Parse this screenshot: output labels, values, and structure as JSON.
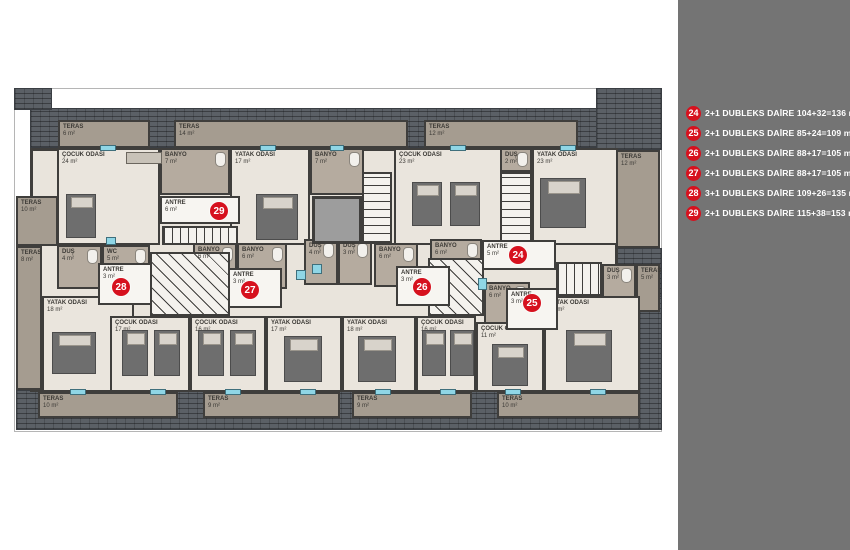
{
  "legend": {
    "items": [
      {
        "no": "24",
        "text": "2+1 DUBLEKS DAİRE 104+32=136 m²"
      },
      {
        "no": "25",
        "text": "2+1 DUBLEKS DAİRE 85+24=109 m²"
      },
      {
        "no": "26",
        "text": "2+1 DUBLEKS DAİRE 88+17=105 m²"
      },
      {
        "no": "27",
        "text": "2+1 DUBLEKS DAİRE 88+17=105 m²"
      },
      {
        "no": "28",
        "text": "3+1 DUBLEKS DAİRE 109+26=135 m²"
      },
      {
        "no": "29",
        "text": "2+1 DUBLEKS DAİRE 115+38=153 m²"
      }
    ],
    "panel_color": "#747474",
    "badge_color": "#d6111e"
  },
  "plan": {
    "hatch": [
      {
        "x": 30,
        "y": 108,
        "w": 586,
        "h": 40
      },
      {
        "x": 14,
        "y": 88,
        "w": 38,
        "h": 22
      },
      {
        "x": 596,
        "y": 88,
        "w": 66,
        "h": 62
      },
      {
        "x": 614,
        "y": 248,
        "w": 48,
        "h": 62
      },
      {
        "x": 612,
        "y": 296,
        "w": 50,
        "h": 134
      },
      {
        "x": 16,
        "y": 390,
        "w": 624,
        "h": 40
      }
    ],
    "rooms": [
      {
        "kind": "terrace",
        "name": "TERAS",
        "area": "6 m²",
        "x": 58,
        "y": 120,
        "w": 92,
        "h": 28
      },
      {
        "kind": "terrace",
        "name": "TERAS",
        "area": "14 m²",
        "x": 174,
        "y": 120,
        "w": 234,
        "h": 28
      },
      {
        "kind": "terrace",
        "name": "TERAS",
        "area": "12 m²",
        "x": 424,
        "y": 120,
        "w": 154,
        "h": 28
      },
      {
        "kind": "terrace",
        "name": "TERAS",
        "area": "12 m²",
        "x": 616,
        "y": 150,
        "w": 44,
        "h": 98
      },
      {
        "kind": "terrace",
        "name": "TERAS",
        "area": "10 m²",
        "x": 16,
        "y": 196,
        "w": 42,
        "h": 50
      },
      {
        "kind": "terrace",
        "name": "TERAS",
        "area": "8 m²",
        "x": 16,
        "y": 246,
        "w": 26,
        "h": 144
      },
      {
        "kind": "terrace",
        "name": "TERAS",
        "area": "5 m²",
        "x": 636,
        "y": 264,
        "w": 24,
        "h": 48
      },
      {
        "kind": "terrace",
        "name": "TERAS",
        "area": "10 m²",
        "x": 38,
        "y": 392,
        "w": 140,
        "h": 26
      },
      {
        "kind": "terrace",
        "name": "TERAS",
        "area": "9 m²",
        "x": 203,
        "y": 392,
        "w": 137,
        "h": 26
      },
      {
        "kind": "terrace",
        "name": "TERAS",
        "area": "9 m²",
        "x": 352,
        "y": 392,
        "w": 120,
        "h": 26
      },
      {
        "kind": "terrace",
        "name": "TERAS",
        "area": "10 m²",
        "x": 497,
        "y": 392,
        "w": 143,
        "h": 26
      },
      {
        "kind": "room",
        "name": "ÇOCUK ODASI",
        "area": "24 m²",
        "x": 57,
        "y": 148,
        "w": 103,
        "h": 97
      },
      {
        "kind": "wet",
        "name": "BANYO",
        "area": "7 m²",
        "x": 160,
        "y": 148,
        "w": 70,
        "h": 47
      },
      {
        "kind": "room",
        "name": "YATAK ODASI",
        "area": "17 m²",
        "x": 230,
        "y": 148,
        "w": 80,
        "h": 97
      },
      {
        "kind": "wet",
        "name": "BANYO",
        "area": "7 m²",
        "x": 310,
        "y": 148,
        "w": 54,
        "h": 47
      },
      {
        "kind": "room",
        "name": "ÇOCUK ODASI",
        "area": "23 m²",
        "x": 394,
        "y": 148,
        "w": 108,
        "h": 97
      },
      {
        "kind": "wet",
        "name": "DUŞ",
        "area": "2 m²",
        "x": 500,
        "y": 148,
        "w": 32,
        "h": 24
      },
      {
        "kind": "room",
        "name": "YATAK ODASI",
        "area": "23 m²",
        "x": 532,
        "y": 148,
        "w": 86,
        "h": 97
      },
      {
        "kind": "wet",
        "name": "DUŞ",
        "area": "4 m²",
        "x": 57,
        "y": 245,
        "w": 45,
        "h": 44
      },
      {
        "kind": "wet",
        "name": "WC",
        "area": "5 m²",
        "x": 102,
        "y": 245,
        "w": 48,
        "h": 40
      },
      {
        "kind": "wet",
        "name": "BANYO",
        "area": "6 m²",
        "x": 193,
        "y": 243,
        "w": 44,
        "h": 42
      },
      {
        "kind": "wet",
        "name": "BANYO",
        "area": "6 m²",
        "x": 237,
        "y": 243,
        "w": 50,
        "h": 46
      },
      {
        "kind": "wet",
        "name": "DUŞ",
        "area": "4 m²",
        "x": 304,
        "y": 239,
        "w": 34,
        "h": 46
      },
      {
        "kind": "wet",
        "name": "DUŞ",
        "area": "3 m²",
        "x": 338,
        "y": 239,
        "w": 34,
        "h": 46
      },
      {
        "kind": "wet",
        "name": "BANYO",
        "area": "6 m²",
        "x": 374,
        "y": 243,
        "w": 44,
        "h": 44
      },
      {
        "kind": "wet",
        "name": "BANYO",
        "area": "6 m²",
        "x": 430,
        "y": 239,
        "w": 52,
        "h": 34
      },
      {
        "kind": "wet",
        "name": "BANYO",
        "area": "6 m²",
        "x": 484,
        "y": 282,
        "w": 46,
        "h": 42
      },
      {
        "kind": "wet",
        "name": "DUŞ",
        "area": "3 m²",
        "x": 602,
        "y": 264,
        "w": 34,
        "h": 34
      },
      {
        "kind": "hall",
        "name": "ANTRE",
        "area": "6 m²",
        "x": 160,
        "y": 196,
        "w": 80,
        "h": 28
      },
      {
        "kind": "hall",
        "name": "ANTRE",
        "area": "3 m²",
        "x": 98,
        "y": 263,
        "w": 54,
        "h": 42
      },
      {
        "kind": "hall",
        "name": "ANTRE",
        "area": "3 m²",
        "x": 228,
        "y": 268,
        "w": 54,
        "h": 40
      },
      {
        "kind": "hall",
        "name": "ANTRE",
        "area": "3 m²",
        "x": 396,
        "y": 266,
        "w": 54,
        "h": 40
      },
      {
        "kind": "hall",
        "name": "ANTRE",
        "area": "5 m²",
        "x": 482,
        "y": 240,
        "w": 74,
        "h": 30
      },
      {
        "kind": "hall",
        "name": "ANTRE",
        "area": "3 m²",
        "x": 506,
        "y": 288,
        "w": 52,
        "h": 42
      },
      {
        "kind": "room",
        "name": "YATAK ODASI",
        "area": "18 m²",
        "x": 42,
        "y": 296,
        "w": 92,
        "h": 96
      },
      {
        "kind": "room",
        "name": "ÇOCUK ODASI",
        "area": "17 m²",
        "x": 110,
        "y": 316,
        "w": 80,
        "h": 76
      },
      {
        "kind": "room",
        "name": "ÇOCUK ODASI",
        "area": "16 m²",
        "x": 190,
        "y": 316,
        "w": 76,
        "h": 76
      },
      {
        "kind": "room",
        "name": "YATAK ODASI",
        "area": "17 m²",
        "x": 266,
        "y": 316,
        "w": 76,
        "h": 76
      },
      {
        "kind": "room",
        "name": "YATAK ODASI",
        "area": "18 m²",
        "x": 342,
        "y": 316,
        "w": 74,
        "h": 76
      },
      {
        "kind": "room",
        "name": "ÇOCUK ODASI",
        "area": "16 m²",
        "x": 416,
        "y": 316,
        "w": 60,
        "h": 76
      },
      {
        "kind": "room",
        "name": "ÇOCUK ODASI",
        "area": "11 m²",
        "x": 476,
        "y": 322,
        "w": 68,
        "h": 70
      },
      {
        "kind": "room",
        "name": "YATAK ODASI",
        "area": "19 m²",
        "x": 544,
        "y": 296,
        "w": 96,
        "h": 96
      }
    ],
    "stairs": [
      {
        "dir": "h",
        "x": 162,
        "y": 226,
        "w": 76,
        "h": 19
      },
      {
        "dir": "v",
        "x": 362,
        "y": 172,
        "w": 30,
        "h": 72
      },
      {
        "dir": "v",
        "x": 500,
        "y": 172,
        "w": 32,
        "h": 72
      },
      {
        "dir": "w",
        "x": 150,
        "y": 252,
        "w": 80,
        "h": 64
      },
      {
        "dir": "w",
        "x": 428,
        "y": 258,
        "w": 56,
        "h": 58
      },
      {
        "dir": "h",
        "x": 556,
        "y": 262,
        "w": 46,
        "h": 34
      }
    ],
    "shaft": {
      "x": 312,
      "y": 196,
      "w": 50,
      "h": 48
    },
    "badges": [
      {
        "no": "29",
        "x": 219,
        "y": 211
      },
      {
        "no": "28",
        "x": 121,
        "y": 287
      },
      {
        "no": "27",
        "x": 250,
        "y": 290
      },
      {
        "no": "26",
        "x": 422,
        "y": 287
      },
      {
        "no": "25",
        "x": 532,
        "y": 303
      },
      {
        "no": "24",
        "x": 518,
        "y": 255
      }
    ],
    "furniture": [
      {
        "type": "bed",
        "x": 66,
        "y": 194,
        "w": 30,
        "h": 44
      },
      {
        "type": "wardrobe",
        "x": 126,
        "y": 152,
        "w": 36,
        "h": 12
      },
      {
        "type": "bed",
        "x": 256,
        "y": 194,
        "w": 42,
        "h": 46
      },
      {
        "type": "bed",
        "x": 540,
        "y": 178,
        "w": 46,
        "h": 50
      },
      {
        "type": "bed",
        "x": 412,
        "y": 182,
        "w": 30,
        "h": 44
      },
      {
        "type": "bed",
        "x": 450,
        "y": 182,
        "w": 30,
        "h": 44
      },
      {
        "type": "bed",
        "x": 52,
        "y": 332,
        "w": 44,
        "h": 42
      },
      {
        "type": "bed",
        "x": 122,
        "y": 330,
        "w": 26,
        "h": 46
      },
      {
        "type": "bed",
        "x": 154,
        "y": 330,
        "w": 26,
        "h": 46
      },
      {
        "type": "bed",
        "x": 198,
        "y": 330,
        "w": 26,
        "h": 46
      },
      {
        "type": "bed",
        "x": 230,
        "y": 330,
        "w": 26,
        "h": 46
      },
      {
        "type": "bed",
        "x": 284,
        "y": 336,
        "w": 38,
        "h": 46
      },
      {
        "type": "bed",
        "x": 358,
        "y": 336,
        "w": 38,
        "h": 46
      },
      {
        "type": "bed",
        "x": 422,
        "y": 330,
        "w": 24,
        "h": 46
      },
      {
        "type": "bed",
        "x": 450,
        "y": 330,
        "w": 24,
        "h": 46
      },
      {
        "type": "bed",
        "x": 492,
        "y": 344,
        "w": 36,
        "h": 42
      },
      {
        "type": "bed",
        "x": 566,
        "y": 330,
        "w": 46,
        "h": 52
      }
    ],
    "windows": [
      {
        "x": 100,
        "y": 145,
        "w": 16,
        "h": 6
      },
      {
        "x": 260,
        "y": 145,
        "w": 16,
        "h": 6
      },
      {
        "x": 330,
        "y": 145,
        "w": 14,
        "h": 6
      },
      {
        "x": 450,
        "y": 145,
        "w": 16,
        "h": 6
      },
      {
        "x": 560,
        "y": 145,
        "w": 16,
        "h": 6
      },
      {
        "x": 70,
        "y": 389,
        "w": 16,
        "h": 6
      },
      {
        "x": 150,
        "y": 389,
        "w": 16,
        "h": 6
      },
      {
        "x": 225,
        "y": 389,
        "w": 16,
        "h": 6
      },
      {
        "x": 300,
        "y": 389,
        "w": 16,
        "h": 6
      },
      {
        "x": 375,
        "y": 389,
        "w": 16,
        "h": 6
      },
      {
        "x": 440,
        "y": 389,
        "w": 16,
        "h": 6
      },
      {
        "x": 505,
        "y": 389,
        "w": 16,
        "h": 6
      },
      {
        "x": 590,
        "y": 389,
        "w": 16,
        "h": 6
      },
      {
        "x": 106,
        "y": 237,
        "w": 10,
        "h": 8
      },
      {
        "x": 312,
        "y": 264,
        "w": 10,
        "h": 10
      },
      {
        "x": 296,
        "y": 270,
        "w": 10,
        "h": 10
      },
      {
        "x": 478,
        "y": 278,
        "w": 9,
        "h": 12
      }
    ]
  }
}
